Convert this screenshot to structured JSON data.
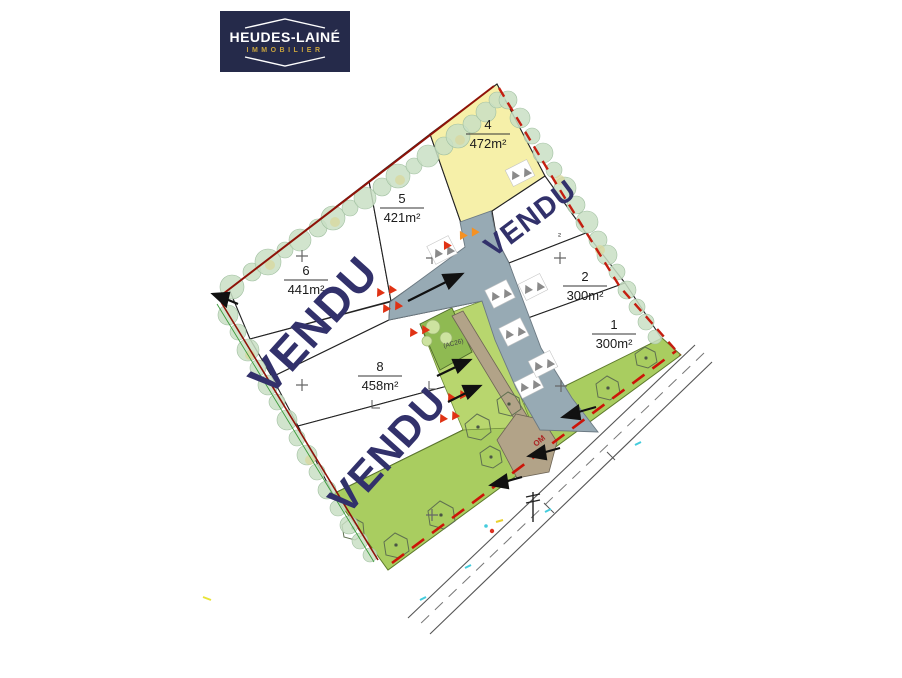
{
  "logo": {
    "title": "HEUDES-LAINÉ",
    "subtitle": "IMMOBILIER"
  },
  "plan": {
    "sold_label": "VENDU",
    "lots": {
      "lot1": {
        "num": "1",
        "area": "300m²"
      },
      "lot2": {
        "num": "2",
        "area": "300m²"
      },
      "lot3": {
        "status": "VENDU"
      },
      "lot4": {
        "num": "4",
        "area": "472m²"
      },
      "lot5": {
        "num": "5",
        "area": "421m²"
      },
      "lot6": {
        "num": "6",
        "area": "441m²"
      },
      "lot7": {
        "status": "VENDU"
      },
      "lot7b": {
        "status": "VENDU"
      },
      "lot8": {
        "num": "8",
        "area": "458m²"
      }
    },
    "annotations": {
      "parcel_ref": "(AC26)",
      "street_marker": "OM",
      "sup_mark": "²"
    }
  },
  "colors": {
    "logo_navy": "#252a4a",
    "logo_gold": "#c9a43e",
    "sold_text": "#32316b",
    "lot_highlight": "#f6f0a9",
    "road": "#97aab4",
    "green_strip": "#a9cd60",
    "green_light": "#b8d66e",
    "green_parcel": "#8fba52",
    "tan": "#b2a388",
    "boundary_red": "#b01708",
    "marker_red": "#e03214",
    "marker_orange": "#f59122"
  }
}
